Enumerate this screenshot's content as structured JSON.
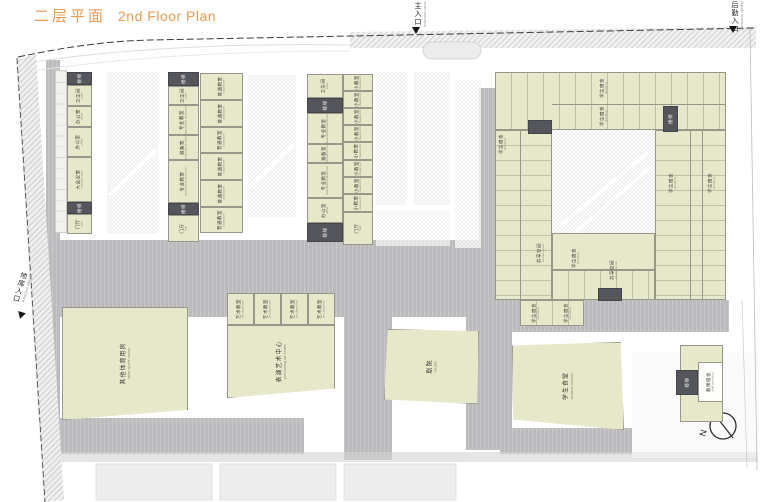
{
  "title": {
    "zh": "二层平面",
    "en": "2nd Floor Plan"
  },
  "entrances": {
    "main": {
      "zh": "主入口",
      "en": "main entrance"
    },
    "service": {
      "zh": "后勤入口",
      "en": "logistic entrance"
    },
    "garage": {
      "zh": "地库入口",
      "en": "garage entrance"
    }
  },
  "labels": {
    "stair": {
      "zh": "楼梯",
      "en": "stair"
    },
    "toilet": {
      "zh": "卫生间",
      "en": "toilet"
    },
    "office": {
      "zh": "办公室",
      "en": "office"
    },
    "meeting": {
      "zh": "大会议室",
      "en": "meeting room"
    },
    "hall": {
      "zh": "门厅",
      "en": "hall"
    },
    "classroom": {
      "zh": "普通教室",
      "en": "classroom"
    },
    "smallClassroom": {
      "zh": "小教室",
      "en": "classroom"
    },
    "specialClassroom": {
      "zh": "专业教室",
      "en": "specialized classroom"
    },
    "prep": {
      "zh": "准备室",
      "en": "preparation room"
    },
    "artClassroom": {
      "zh": "艺术教室",
      "en": "art classroom"
    },
    "dormitory": {
      "zh": "学生宿舍",
      "en": "dormitory"
    },
    "shared": {
      "zh": "共享空间",
      "en": "shared space"
    },
    "sports": {
      "zh": "其他体育用房",
      "en": "other sports rooms"
    },
    "performing": {
      "zh": "表演艺术中心",
      "en": "performing art center"
    },
    "theater": {
      "zh": "剧院",
      "en": "theater"
    },
    "canteen": {
      "zh": "学生食堂",
      "en": "student canteen"
    },
    "staffDorm": {
      "zh": "教师宿舍",
      "en": "staff dormitory"
    }
  },
  "compass": {
    "label": "N"
  }
}
